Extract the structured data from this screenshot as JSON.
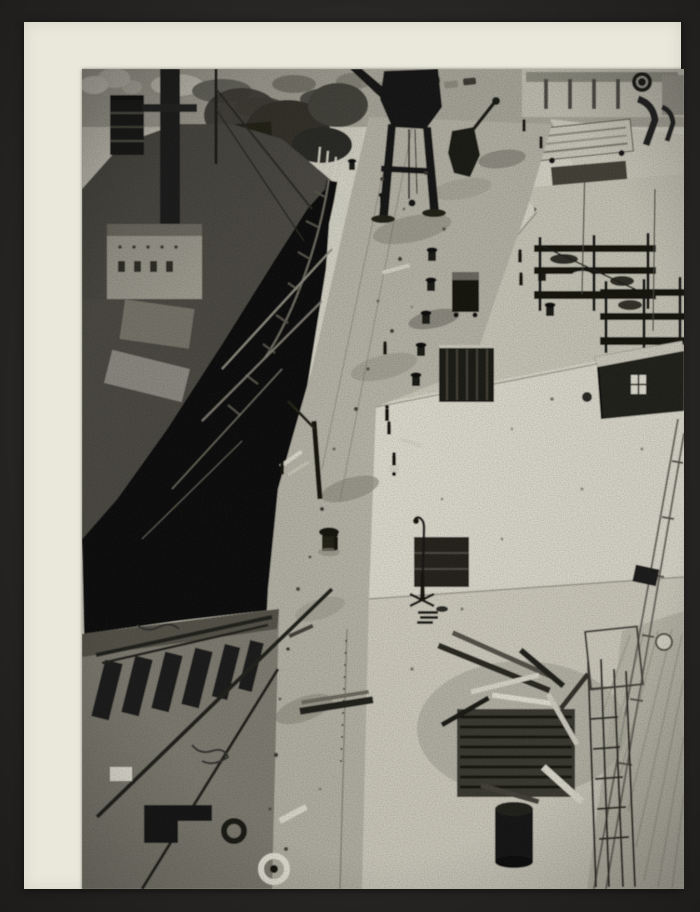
{
  "photo": {
    "alt": "Elevated black-and-white photograph of a harbour quay under reconstruction. A cargo steamship with a smoking funnel, masts and derricks is moored along the left. A dark portal crane stands at the top centre above a rubble-strewn quay strip lined with bollards, open shored pits and small figures of workers. To the right stretch wide light concrete aprons with steel scaffolding racks, a dark wooden site hut with a white window, parked trailers and containers along a road at the top, a gooseneck lamp post on the open apron, a railway track running to the lower right, and a heap of salvaged timber with a black drum and ladders near the bottom. A barge deck with dark hatches, rails, ropes and mooring rings fills the lower left corner.",
    "medium": "gelatin silver print mounted on cream card inside a dark album page",
    "visible_text": []
  },
  "colors": {
    "frame_color": "#292725",
    "mat_color": "#e9e8db",
    "photo_base": "#c4c2b4",
    "highlight_tone": "#d9d7ca",
    "light_tone": "#c6c4b6",
    "mid_tone": "#8e8c80",
    "dark_tone": "#3a3833",
    "black_tone": "#121210"
  },
  "scene_elements": [
    "cargo-ship",
    "ship-funnel",
    "steam-plume",
    "ship-superstructure",
    "ship-bulwark",
    "harbour-water",
    "barge-deck",
    "mooring-rings",
    "portal-crane",
    "excavator",
    "quay-rubble-strip",
    "bollards",
    "worker-figures",
    "shored-pit",
    "concrete-aprons",
    "expansion-joints",
    "scaffolding-racks",
    "site-hut",
    "hut-window",
    "lamp-post",
    "railway-track",
    "debris-pile",
    "tar-drum",
    "ladders",
    "trailers-and-containers",
    "quayside-buildings",
    "road"
  ]
}
